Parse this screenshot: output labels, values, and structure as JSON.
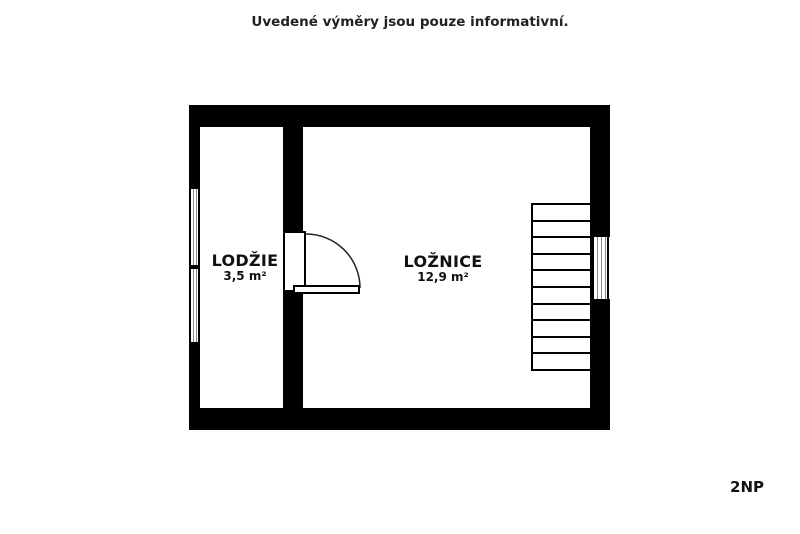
{
  "disclaimer": "Uvedené výměry jsou pouze informativní.",
  "floor_label": "2NP",
  "rooms": [
    {
      "name": "LODŽIE",
      "area": "3,5 m²"
    },
    {
      "name": "LOŽNICE",
      "area": "12,9 m²"
    }
  ],
  "stairs": {
    "steps": 10
  },
  "icons": {
    "door_swing": "door-swing-arc",
    "window_symbol": "triple-line-window"
  },
  "colors": {
    "wall": "#000000",
    "text": "#1a1a1a",
    "window_line": "#888888",
    "door_stroke": "#222222"
  }
}
